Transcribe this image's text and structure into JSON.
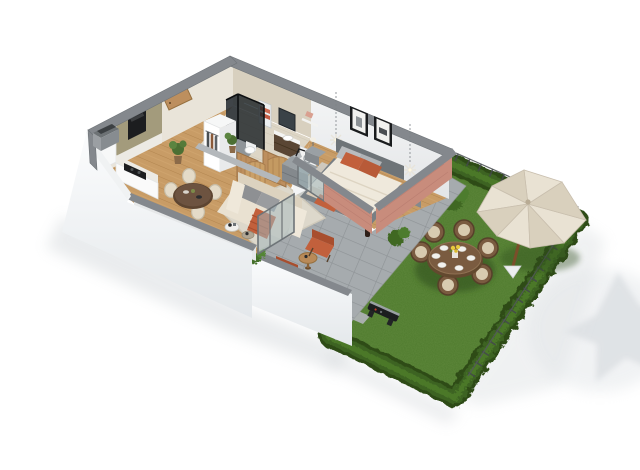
{
  "scene": {
    "type": "3d-floorplan-render",
    "view": "isometric-perspective",
    "rooms": [
      {
        "name": "kitchen"
      },
      {
        "name": "dining-area"
      },
      {
        "name": "living-room"
      },
      {
        "name": "hallway"
      },
      {
        "name": "bathroom"
      },
      {
        "name": "bedroom"
      },
      {
        "name": "terrace"
      },
      {
        "name": "garden"
      }
    ],
    "objects": [
      "kitchen-cabinets",
      "built-in-oven",
      "cooktop",
      "fridge-column",
      "dining-table",
      "dining-chairs",
      "potted-plants",
      "entry-door",
      "wardrobe-clothes",
      "shower",
      "vanity-sink",
      "mirror",
      "towel-radiator",
      "washing-machine",
      "toilet",
      "sofa",
      "coffee-tables",
      "tv",
      "rug",
      "wood-slat-screens",
      "double-bed",
      "nightstands",
      "table-lamps",
      "dresser",
      "wall-art-frames",
      "pendant-lights",
      "sliding-glass-door",
      "terrace-armchairs",
      "terrace-side-table",
      "decor-bottle",
      "garden-round-dining-table",
      "garden-wicker-chairs",
      "parasol",
      "bbq-grill",
      "hedge",
      "lawn",
      "wire-fence",
      "stepping-stones",
      "bushes"
    ]
  },
  "colors": {
    "background": "#ffffff",
    "wall_cap": "#84888d",
    "wall_cap_light": "#b4b8bb",
    "wall_white": "#f1f2f3",
    "wall_inner_left": "#e9e4d9",
    "fascia_top": "#fbfcfd",
    "fascia_bottom": "#e4e8eb",
    "travertine_wall": "#d8d0bf",
    "travertine_floor": "#ddd6c6",
    "terracotta": "#c88c7c",
    "terracotta_dark": "#b3776a",
    "wood_floor": "#c89c66",
    "wood_line": "#b2854f",
    "rug": "#ddd8cb",
    "paver": "#a6abae",
    "paver_line": "#8e9396",
    "grass": "#4e7a2d",
    "grass_dark": "#3c611f",
    "hedge": "#3d6323",
    "hedge_dark": "#2e4c19",
    "hedge_light": "#4f7e2c",
    "sofa": "#e9e1d1",
    "sofa_back": "#dcd2bf",
    "cushion_gray": "#8e9093",
    "accent_orange": "#c2603c",
    "accent_orange_dark": "#a84e2e",
    "bed_frame": "#787f84",
    "bed_duvet": "#efe9dc",
    "kitchen_cabinet": "#a39b7c",
    "counter": "#eceae4",
    "appliance_black": "#1c1d1f",
    "dining_table": "#5d4531",
    "chair_cream": "#e4dbc8",
    "wicker": "#7a5b40",
    "wicker_dark": "#63492f",
    "wicker_cushion": "#d8cbb0",
    "parasol": "#e9e2d3",
    "parasol_shade": "#d9d0bd",
    "parasol_pole": "#7a4e2a",
    "door_wood": "#bd8f5e",
    "glass": "#a3b7bc",
    "glass_frame": "#6e7478",
    "fence": "#43484b",
    "tv": "#121314",
    "shadow": "#cdd2d6"
  }
}
